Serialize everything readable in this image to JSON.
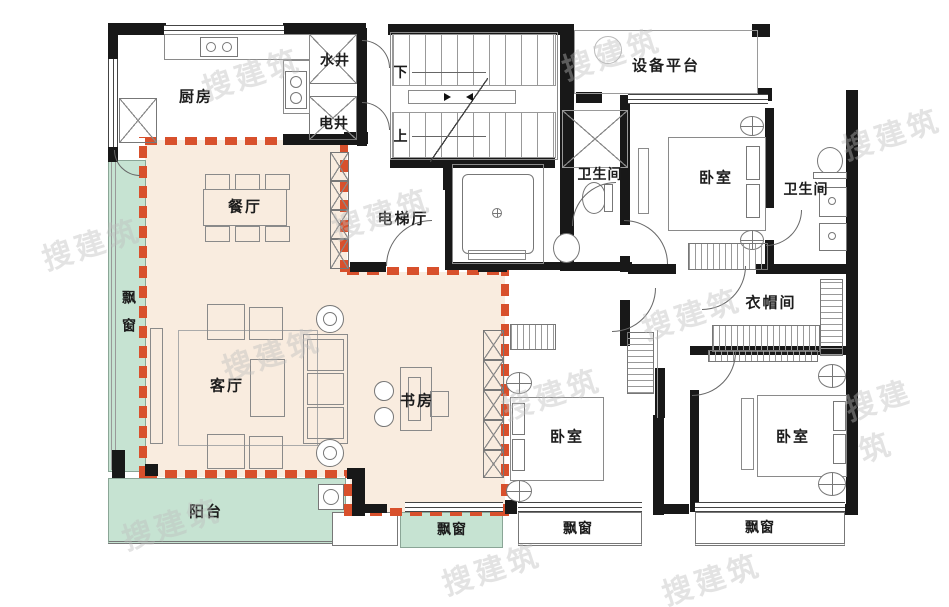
{
  "watermark": {
    "text": "搜建筑"
  },
  "colors": {
    "wall": "#181818",
    "gift_zone_fill": "#f9ecdf",
    "window_balcony_fill": "#c6e3d2",
    "boundary_dash": "#d8502c"
  },
  "rooms": {
    "kitchen": "厨房",
    "water_shaft": "水井",
    "electric_shaft": "电井",
    "stair_down": "下",
    "stair_up": "上",
    "equipment_platform": "设备平台",
    "elevator_hall": "电梯厅",
    "bathroom_top": "卫生间",
    "bathroom_right": "卫生间",
    "bedroom_top_right": "卧室",
    "bedroom_bottom_middle": "卧室",
    "bedroom_bottom_right": "卧室",
    "cloakroom": "衣帽间",
    "dining_room": "餐厅",
    "living_room": "客厅",
    "study": "书房",
    "balcony": "阳台",
    "bay_window_left": "飘窗",
    "bay_window_green": "飘窗",
    "bay_window_middle": "飘窗",
    "bay_window_right": "飘窗"
  }
}
